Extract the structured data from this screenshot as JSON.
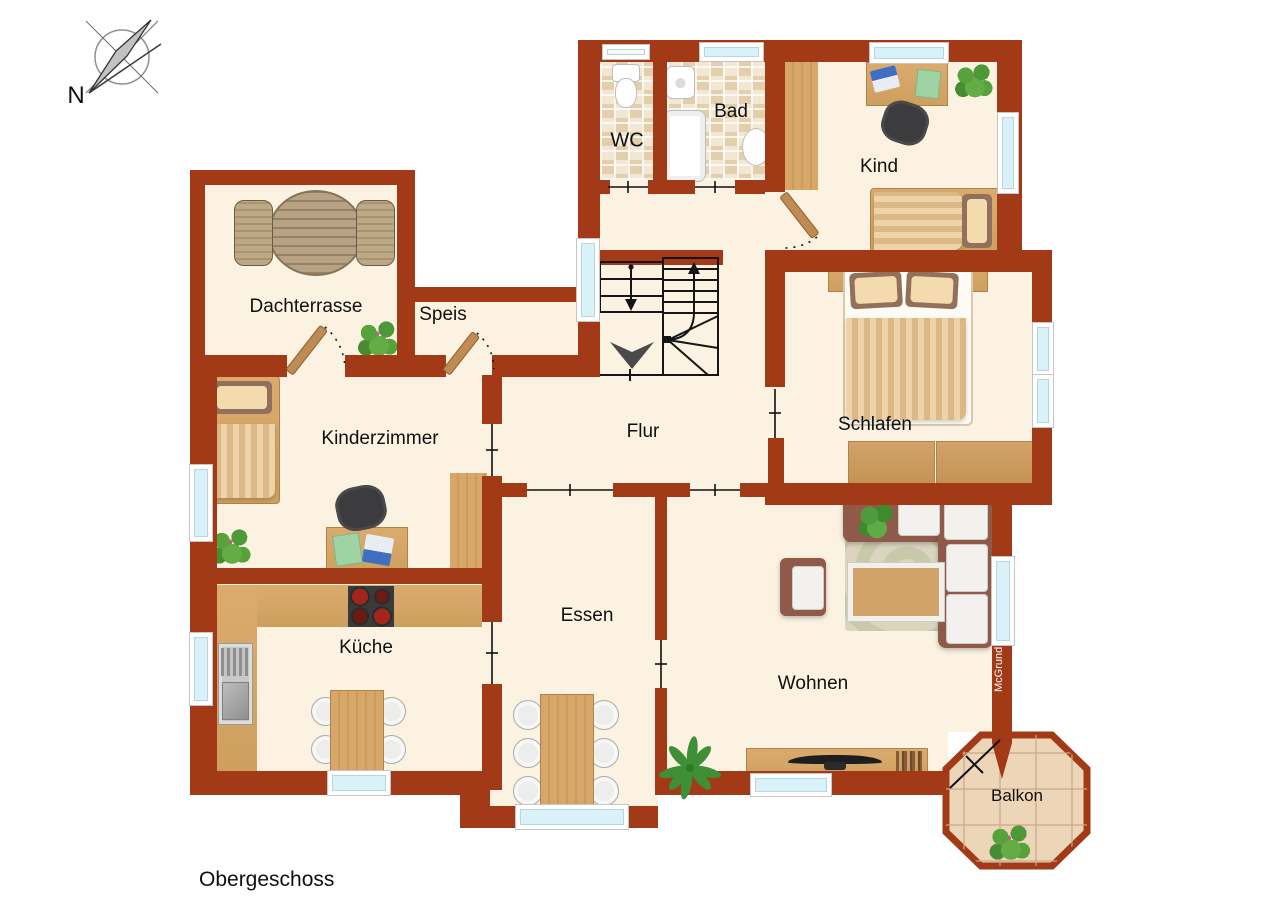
{
  "title": "Obergeschoss",
  "compass": {
    "label": "N"
  },
  "watermark": "McGrundriss",
  "rooms": {
    "wc": {
      "label": "WC"
    },
    "bad": {
      "label": "Bad"
    },
    "kind": {
      "label": "Kind"
    },
    "dachterrasse": {
      "label": "Dachterrasse"
    },
    "speis": {
      "label": "Speis"
    },
    "kinderzimmer": {
      "label": "Kinderzimmer"
    },
    "flur": {
      "label": "Flur"
    },
    "schlafen": {
      "label": "Schlafen"
    },
    "kueche": {
      "label": "Küche"
    },
    "essen": {
      "label": "Essen"
    },
    "wohnen": {
      "label": "Wohnen"
    },
    "balkon": {
      "label": "Balkon"
    }
  },
  "colors": {
    "wall": "#A23917",
    "floor": "#FBF2E1",
    "window_glass": "#D9F1F8",
    "wood": "#D7A76A",
    "bath_tile": "#EDDEC5",
    "balcony_tile": "#EDD5B7",
    "line_art": "#111111",
    "plant_green": "#57A23B",
    "watermark_text": "#FFFFFF"
  },
  "icons": {
    "compass-rose": "svg-circle-needle",
    "stairs": "svg-treads-arrows",
    "direction-arrow": "svg-chevron",
    "door-swing": "svg-leaf-dashed-arc",
    "passage-opening": "svg-line-tick",
    "toilet": "css-shape",
    "sink": "css-shape",
    "bathtub": "css-shape",
    "double-bed": "css-shape",
    "single-bed": "css-shape",
    "wardrobe": "css-wood-rect",
    "desk": "css-wood-rect",
    "office-chair": "css-dark-blob",
    "dining-table": "css-wood-rect",
    "chair": "css-light-circle",
    "round-garden-table": "css-striped-ellipse",
    "garden-chair": "css-striped-rect",
    "sofa": "css-brown-l-shape",
    "coffee-table": "css-framed-wood",
    "rug": "css-swirl-rect",
    "armchair": "css-brown-rect",
    "tv-sideboard": "css-wood-rect",
    "stove": "css-dark-burners",
    "kitchen-sink": "css-gray-rect",
    "dresser": "css-wood-rect",
    "flower-plant": "css-radial-cluster",
    "green-plant": "css-radial-cluster",
    "palm-plant": "svg-leaves",
    "balcony-tiles": "svg-octagon-grid",
    "window": "css-blue-rect"
  }
}
